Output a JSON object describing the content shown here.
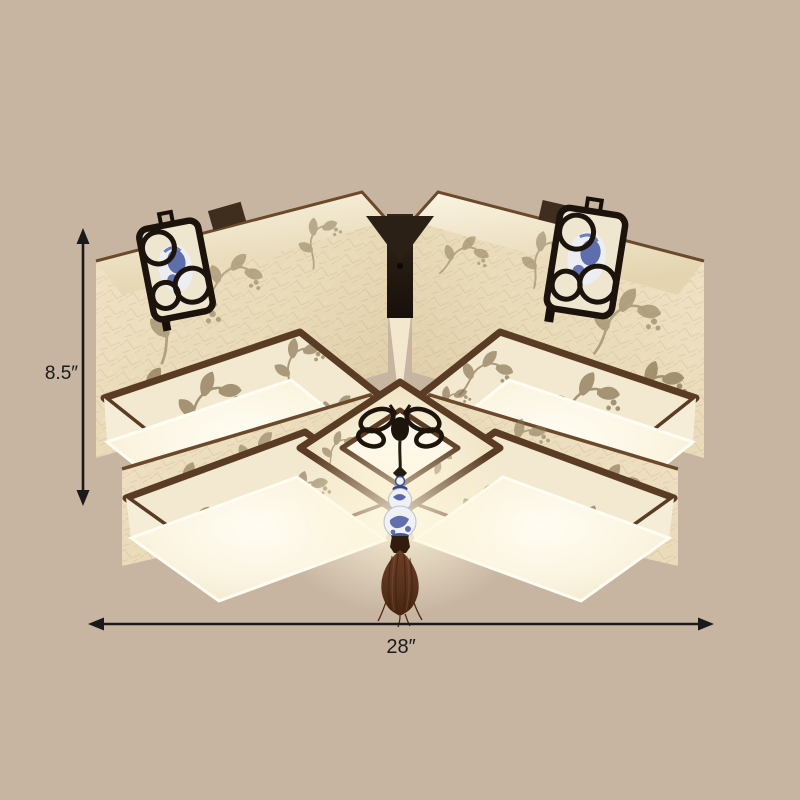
{
  "scene": {
    "background_color": "#c7b5a2",
    "subject": "Chinese-style square fabric flush-mount ceiling light, viewed from below, with dimension arrows"
  },
  "annotations": {
    "height_label": "8.5″",
    "width_label": "28″",
    "arrow_color": "#1a1a1a"
  },
  "fixture": {
    "colors": {
      "fabric": "#eadcbc",
      "fabric_highlight": "#f6efdb",
      "wood_trim": "#5a3b23",
      "diffuser_white": "#fdfaee",
      "embroidery": "#84714f",
      "metal_black": "#201710",
      "porcelain_white": "#f0f1f5",
      "porcelain_blue": "#3c4f9c",
      "tassel_brown": "#5a3320"
    },
    "parts": [
      "upper-left-shade-box",
      "upper-right-shade-box",
      "lower-left-shade-box",
      "lower-right-shade-box",
      "center-diamond-panel",
      "ceiling-canopy-mount",
      "left-porcelain-openwork-panel",
      "right-porcelain-openwork-panel",
      "metal-knot-ornament",
      "porcelain-gourd-pendant",
      "brown-tassel"
    ]
  }
}
